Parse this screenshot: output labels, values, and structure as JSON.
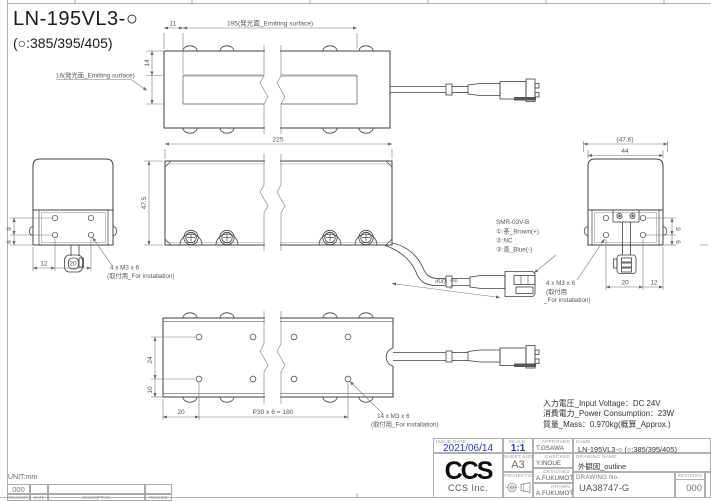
{
  "title": {
    "model": "LN-195VL3-○",
    "variants": "(○:385/395/405)"
  },
  "dims": {
    "top_11": "11",
    "top_195": "195(発光面_Emitting surface)",
    "top_14": "14",
    "top_16_callout": "16(発光面_Emitting surface)",
    "front_width": "225",
    "front_height": "47.5",
    "side_47_6": "(47.6)",
    "side_44": "44",
    "side_9": "9",
    "side_6": "6",
    "side_12": "12",
    "side_20": "20",
    "bottom_24": "24",
    "bottom_10": "10",
    "bottom_20": "20",
    "bottom_pitch": "P30 x 6 = 180",
    "cable_len": "300",
    "cable_tol_up": "+50",
    "cable_tol_low": "0"
  },
  "callouts": {
    "m3_4x_line1": "4 x M3 x 6",
    "m3_4x_line2": "(取付用_For installation)",
    "m3_4x_r_line2a": "(取付用",
    "m3_4x_r_line2b": "_For installation)",
    "m3_14x_line1": "14 x M3 x 6",
    "m3_14x_line2": "(取付用_For installation)",
    "connector_model": "SMR-03V-B",
    "pin1": "①:茶_Brown(+)",
    "pin2": "②:NC",
    "pin3": "③:青_Blue(-)"
  },
  "specs": {
    "input_voltage": "入力電圧_Input Voltage：DC 24V",
    "power": "消費電力_Power Consumption：23W",
    "mass": "質量_Mass：0.970kg(概算_Approx.)"
  },
  "title_block": {
    "issue_date_label": "ISSUE DATE",
    "issue_date": "2021/06/14",
    "scale_label": "SCALE",
    "scale": "1:1",
    "sheet_size_label": "SHEET SIZE",
    "sheet_size": "A3",
    "projection_label": "PROJECTION",
    "approved_label": "APPROVED",
    "approved": "T.OSAWA",
    "checked_label": "CHECKED",
    "checked": "Y.INOUE",
    "designed_label": "DESIGNED",
    "designed": "A.FUKUMOTO",
    "drawn_label": "DRAWN",
    "drawn": "A.FUKUMOTO",
    "name_label": "NAME",
    "name": "LN-195VL3-○ (○:385/395/405)",
    "drawing_name_label": "DRAWING NAME",
    "drawing_name": "外観図_outline",
    "drawing_no_label": "DRAWING No.",
    "drawing_no": "UA38747-G",
    "revision_label": "REVISION",
    "revision": "000",
    "logo": "CCS",
    "company": "CCS Inc."
  },
  "footer": {
    "unit": "UNIT:mm",
    "revision": "000",
    "headers": [
      "REVISION",
      "DATE",
      "DESCRIPTION",
      "REVISED"
    ]
  },
  "colors": {
    "accent_blue": "#2633cc",
    "line_dark": "#3f3f3f",
    "line_dim": "#707070"
  }
}
